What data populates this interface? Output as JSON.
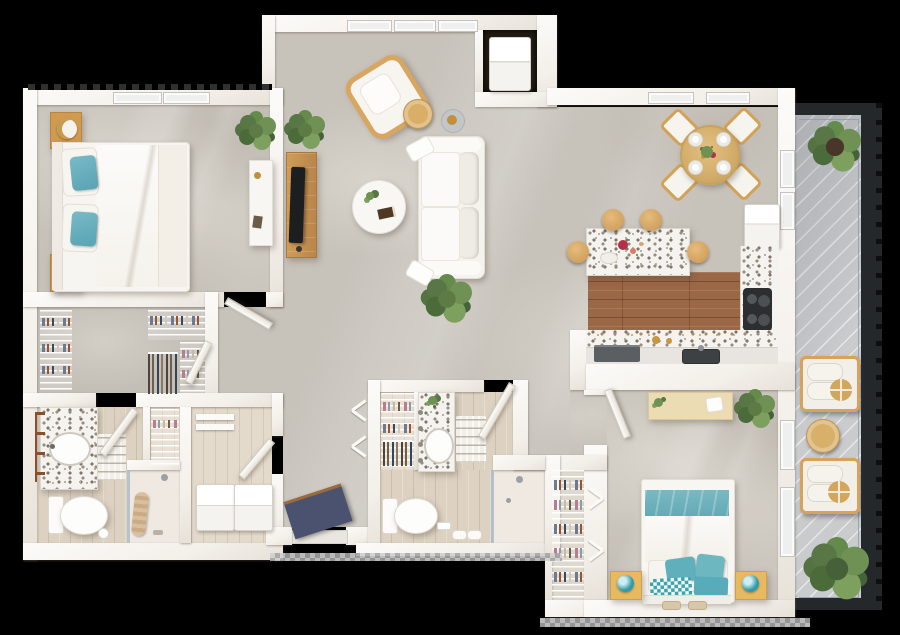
{
  "meta": {
    "kind": "3d-floor-plan-top-view",
    "unit": "two-bedroom two-bath apartment with balcony",
    "background": "#000000"
  },
  "palette": {
    "wall": "#f8f6f2",
    "wallShade": "#e8e3db",
    "concrete": "#c7c2ba",
    "bathFloor": "#ddd2c1",
    "closetFloor": "#d8d0c4",
    "kitchenWood": "#9a6747",
    "terrazzo": "#f5f3ef",
    "teal": "#68b2c2",
    "tealDeep": "#2f9aa8",
    "navyMat": "#4a5270",
    "woodFurniture": "#d5a45f",
    "lightWood": "#ecdcb4",
    "green": "#5d7c45",
    "balconyFloor": "#c9cbcd",
    "balconyFrame": "#24282b",
    "railLine": "#929bb4",
    "applianceDark": "#5c6063",
    "tvBlack": "#1d1e20"
  },
  "rooms": [
    {
      "id": "primary-bedroom",
      "furniture": [
        "king bed with white duvet and teal pillows",
        "2 wood nightstands",
        "2 lamps",
        "white desk",
        "potted plant"
      ]
    },
    {
      "id": "walk-in-closet",
      "furniture": [
        "wire shelving",
        "hanging clothes"
      ]
    },
    {
      "id": "primary-bathroom",
      "furniture": [
        "terrazzo vanity with sink",
        "towel ladder",
        "toilet",
        "zigzag bath mat",
        "walk-in shower with towel",
        "linen shelves"
      ]
    },
    {
      "id": "laundry-room",
      "furniture": [
        "washer",
        "dryer",
        "wall shelves"
      ]
    },
    {
      "id": "entry",
      "furniture": [
        "navy doormat with wood trim"
      ]
    },
    {
      "id": "living-room",
      "furniture": [
        "white sofa",
        "round coffee table with book and plant",
        "rattan accent chair",
        "round wood side table",
        "candle tray",
        "wood tv console",
        "tv",
        "potted plants"
      ]
    },
    {
      "id": "dining-area",
      "furniture": [
        "round wood dining table",
        "4 chairs",
        "4 place settings",
        "centerpiece flowers"
      ]
    },
    {
      "id": "kitchen",
      "furniture": [
        "terrazzo island with flowers",
        "4 bar stools",
        "refrigerator",
        "cooktop",
        "sink",
        "dishwasher",
        "wood floor"
      ]
    },
    {
      "id": "utility-closet",
      "furniture": [
        "water heater"
      ]
    },
    {
      "id": "bathroom-2",
      "furniture": [
        "terrazzo vanity with sink",
        "toilet",
        "zigzag bath mat",
        "shower",
        "reach-in closet with bifold doors",
        "rolled towels"
      ]
    },
    {
      "id": "bedroom-2",
      "furniture": [
        "bed with teal and white bedding",
        "2 yellow nightstands",
        "2 teal lamps",
        "light wood desk",
        "potted plant",
        "reach-in closet",
        "slippers"
      ]
    },
    {
      "id": "balcony",
      "furniture": [
        "2 cushioned lounge chairs",
        "gold round pillows",
        "round wood side table",
        "2 potted plants",
        "dark metal railing"
      ]
    }
  ]
}
